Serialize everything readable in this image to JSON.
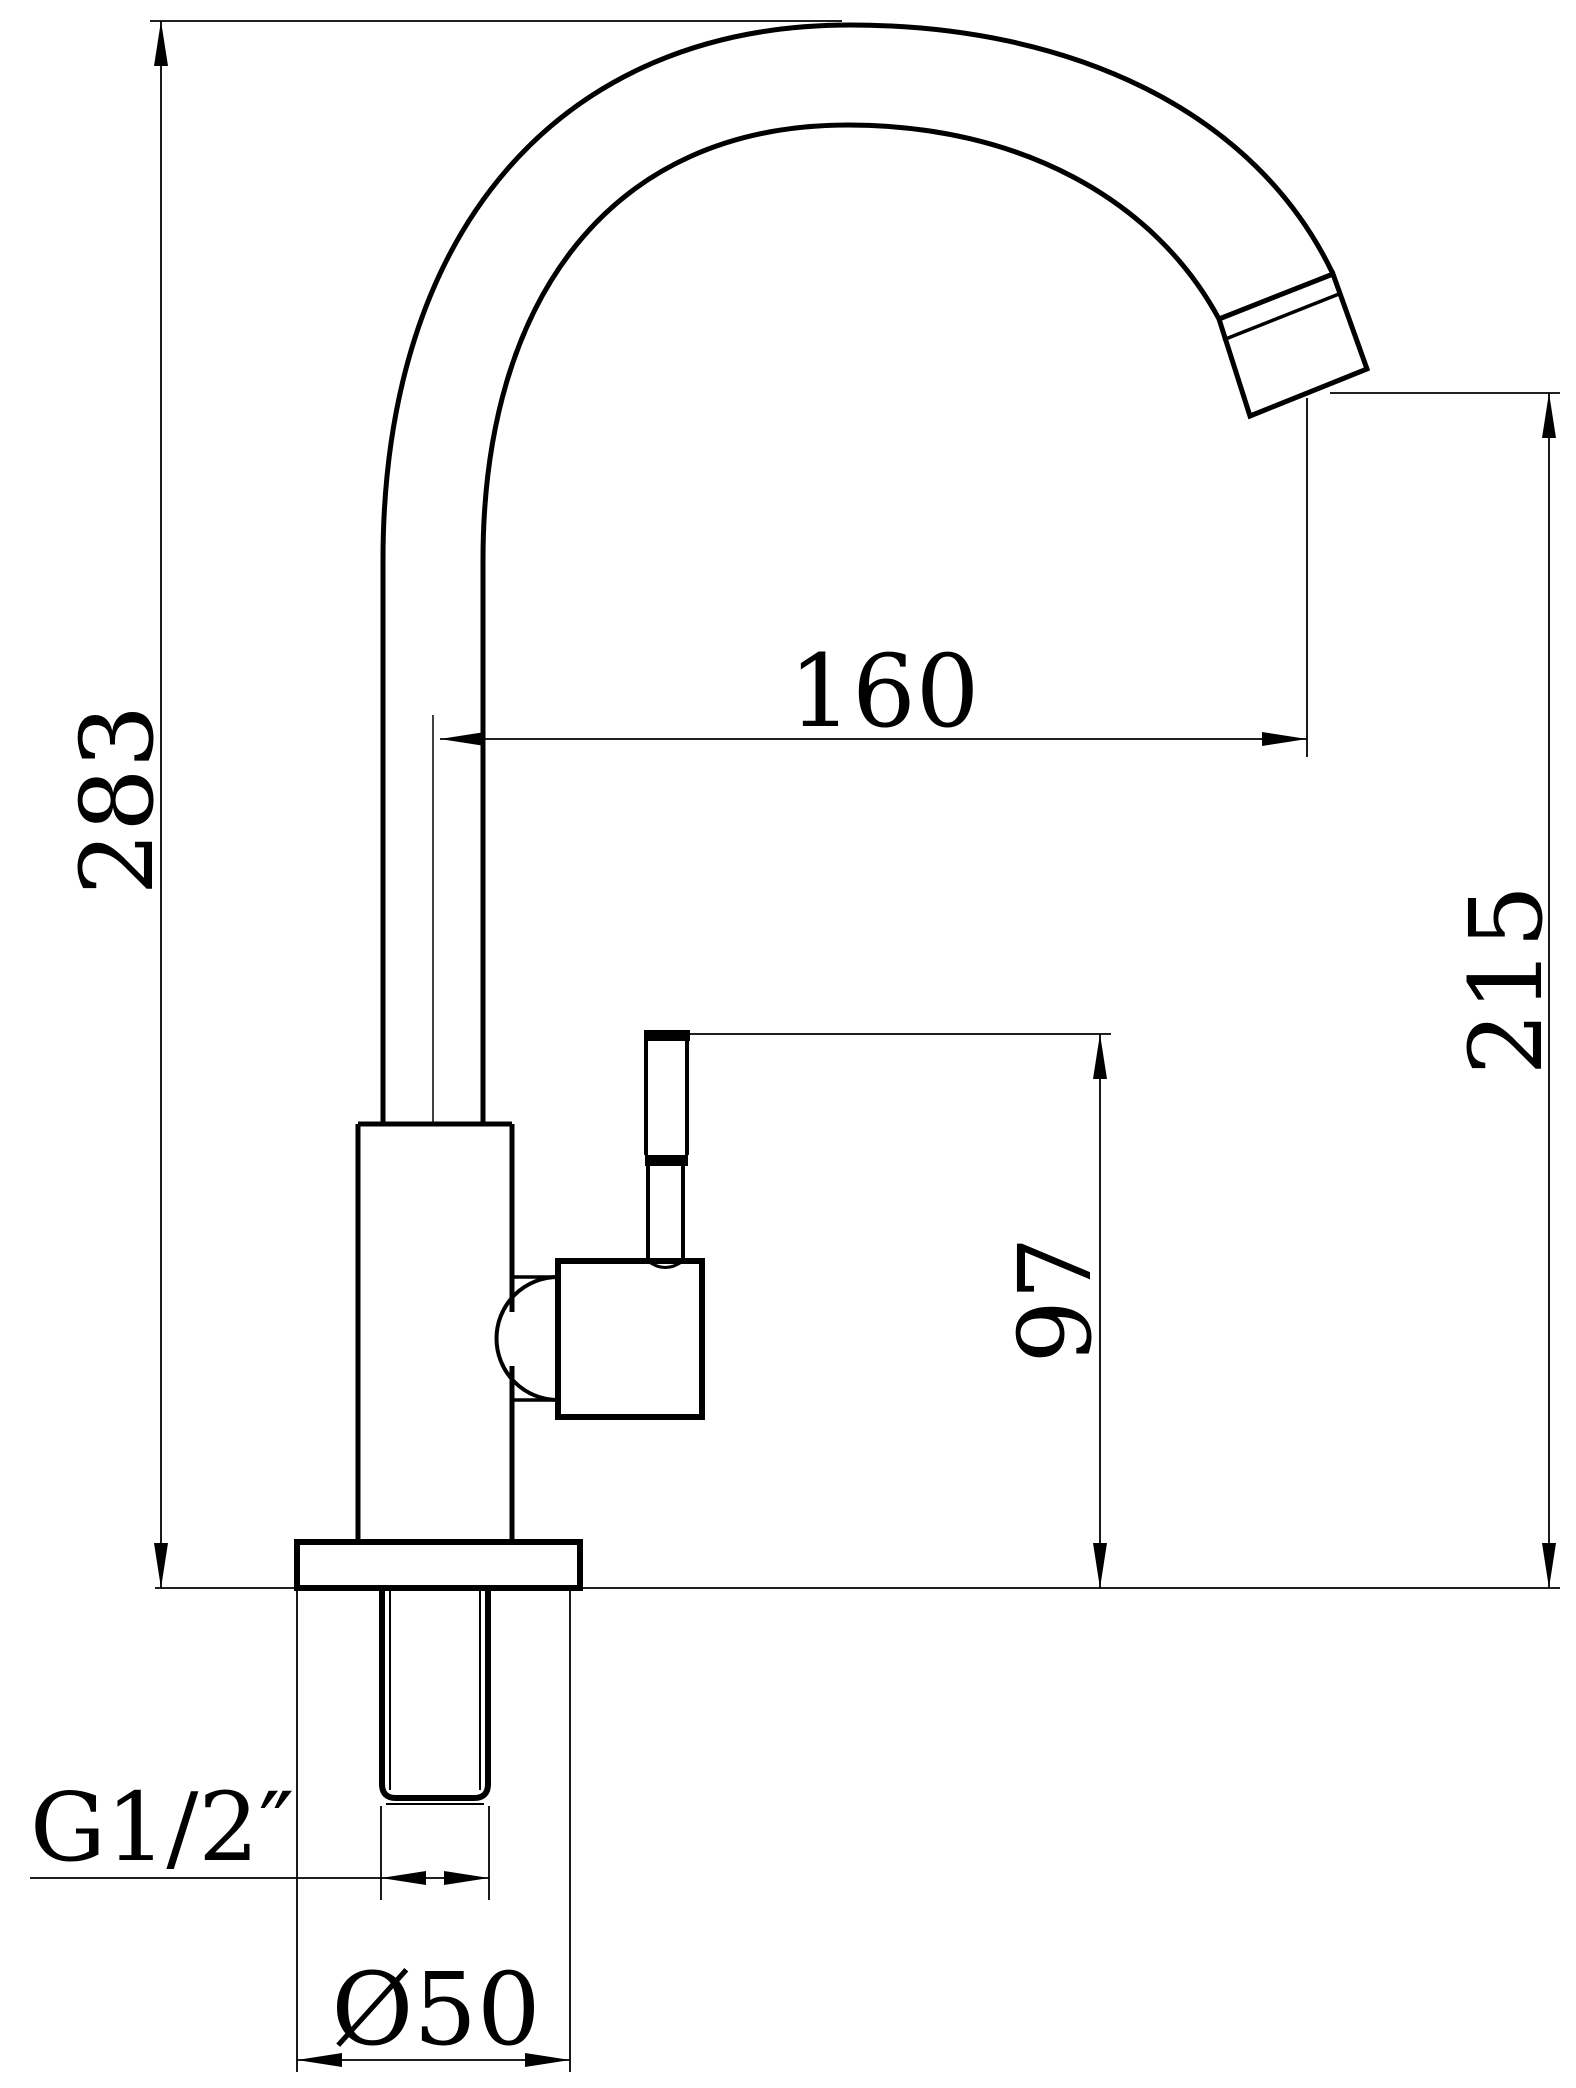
{
  "drawing": {
    "type": "technical-drawing",
    "subject": "single-handle gooseneck faucet, side elevation with dimensions",
    "background_color": "#ffffff",
    "line_color": "#000000",
    "dimensions": {
      "overall_height": {
        "label": "283",
        "orientation": "vertical",
        "location": "left edge"
      },
      "spout_reach": {
        "label": "160",
        "orientation": "horizontal",
        "location": "center, spout centerline to outlet"
      },
      "outlet_height": {
        "label": "215",
        "orientation": "vertical",
        "location": "right edge, outlet to deck"
      },
      "handle_height": {
        "label": "97",
        "orientation": "vertical",
        "location": "handle top to deck"
      },
      "thread": {
        "label": "G1/2″",
        "orientation": "horizontal",
        "location": "bottom left, threaded shank"
      },
      "base_diameter": {
        "label": "Ø50",
        "orientation": "horizontal",
        "location": "bottom, base flange"
      }
    }
  }
}
